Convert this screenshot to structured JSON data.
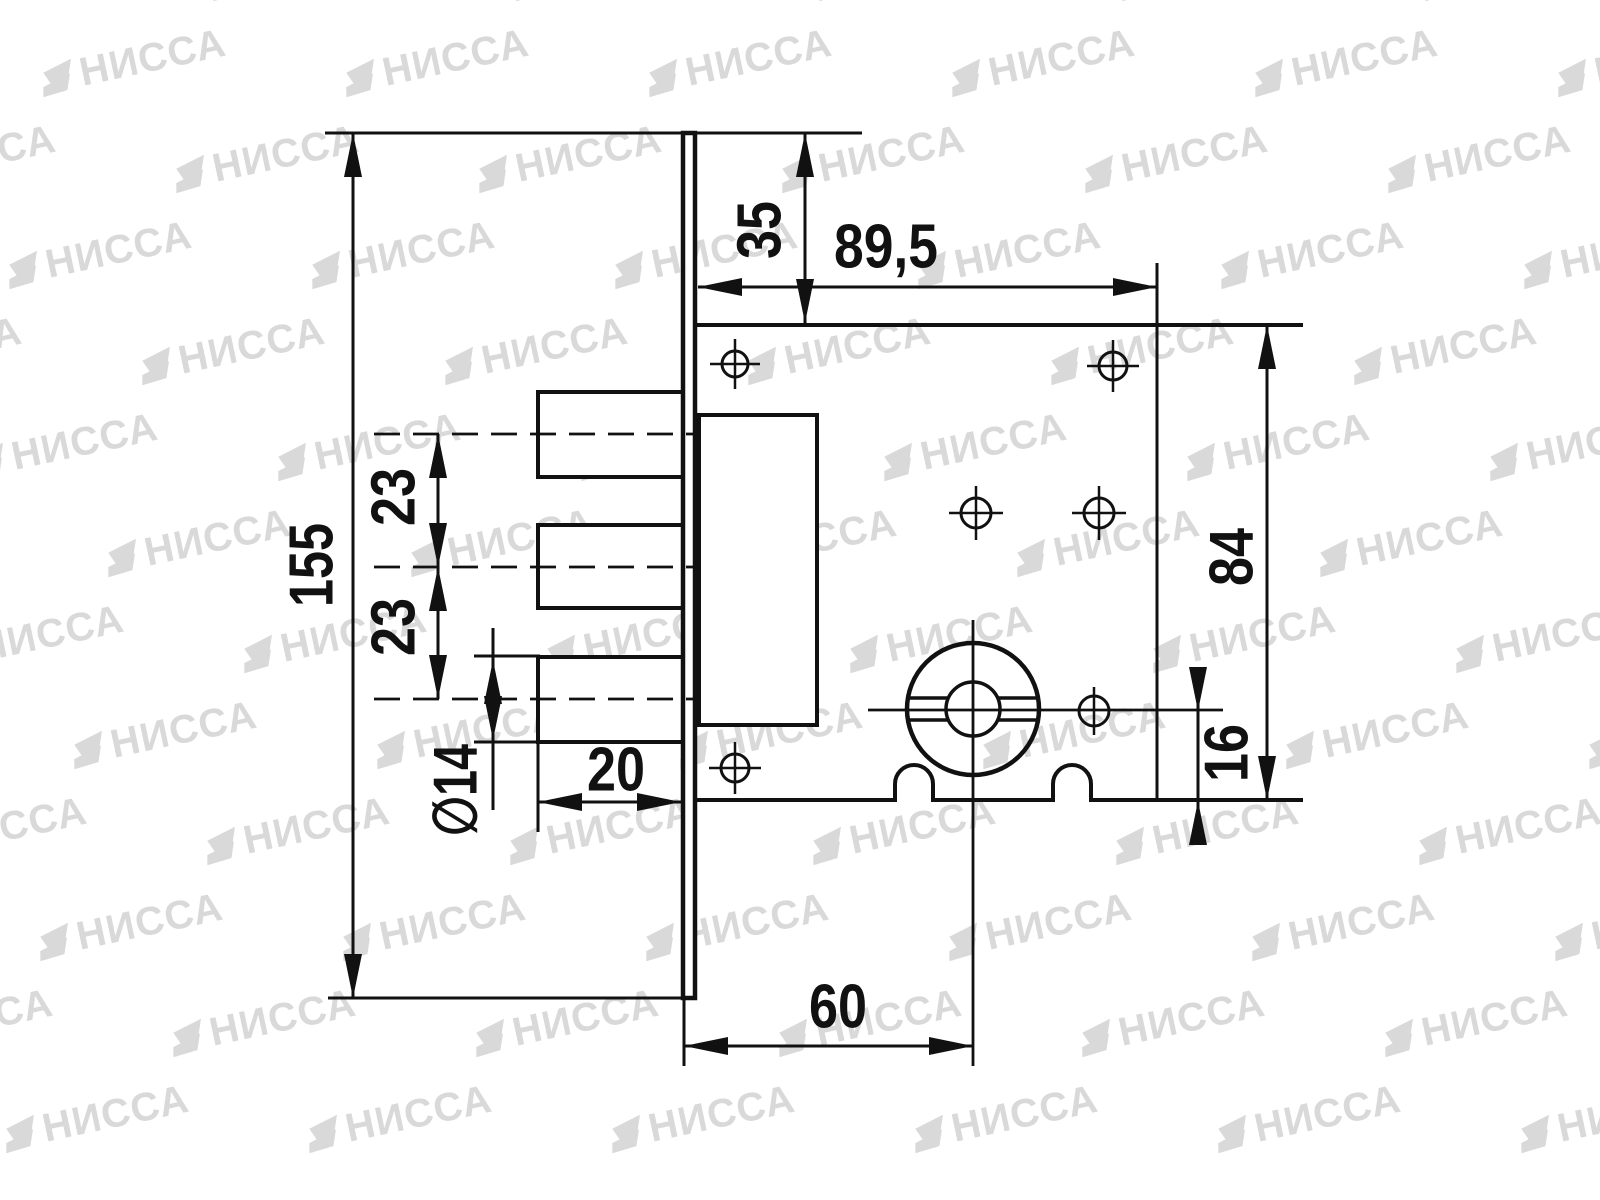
{
  "drawing": {
    "type": "lock-mortise-dimension-drawing",
    "background": "#ffffff",
    "line_color": "#111111"
  },
  "watermark": {
    "text": "НИССА",
    "color": "#d9d9d9",
    "icon": "nissa-logo-mark"
  },
  "dimensions": {
    "plate_height": "155",
    "top_offset": "35",
    "hole_span": "89,5",
    "bolt_pitch_upper": "23",
    "bolt_pitch_lower": "23",
    "bolt_diameter": "∅14",
    "bolt_throw": "20",
    "cylinder_backset": "60",
    "body_height": "84",
    "cylinder_to_bottom": "16"
  }
}
